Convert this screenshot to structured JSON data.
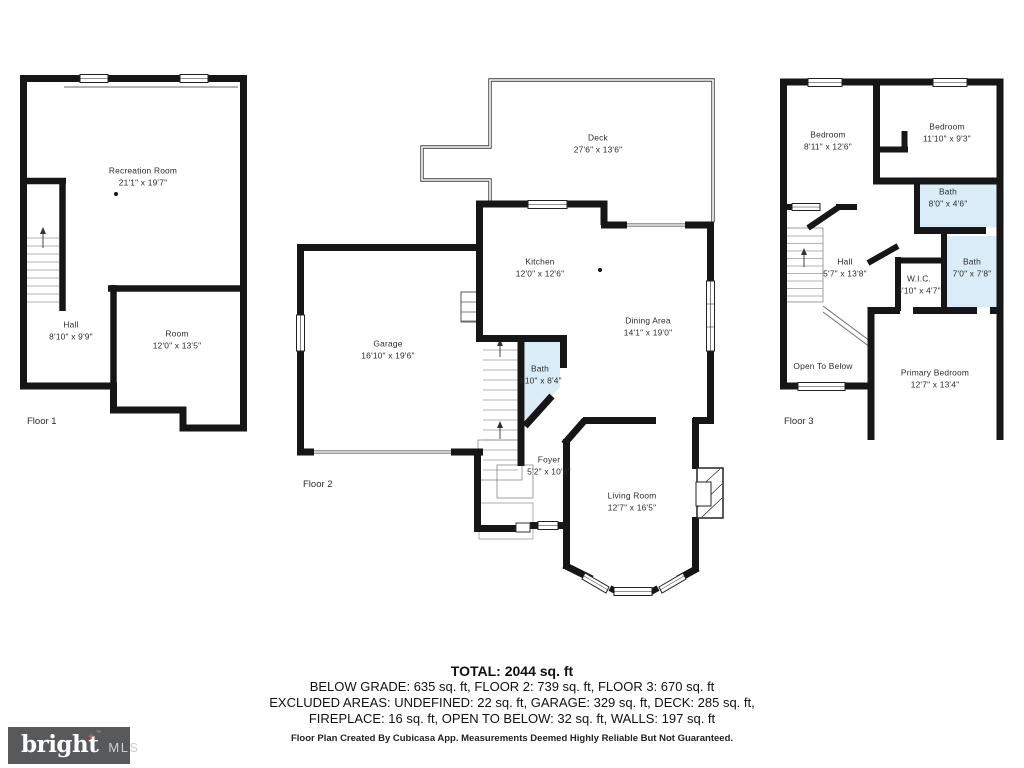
{
  "floors": [
    {
      "label": "Floor 1",
      "rooms": [
        {
          "name": "Recreation Room",
          "dims": "21'1\" x 19'7\""
        },
        {
          "name": "Hall",
          "dims": "8'10\" x 9'9\""
        },
        {
          "name": "Room",
          "dims": "12'0\" x 13'5\""
        }
      ]
    },
    {
      "label": "Floor 2",
      "rooms": [
        {
          "name": "Deck",
          "dims": "27'6\" x 13'6\""
        },
        {
          "name": "Kitchen",
          "dims": "12'0\" x 12'6\""
        },
        {
          "name": "Dining Area",
          "dims": "14'1\" x 19'0\""
        },
        {
          "name": "Garage",
          "dims": "16'10\" x 19'6\""
        },
        {
          "name": "Bath",
          "dims": "3'10\" x 8'4\""
        },
        {
          "name": "Foyer",
          "dims": "5'2\" x 10'8\""
        },
        {
          "name": "Living Room",
          "dims": "12'7\" x 16'5\""
        }
      ]
    },
    {
      "label": "Floor 3",
      "rooms": [
        {
          "name": "Bedroom",
          "dims": "8'11\" x 12'6\""
        },
        {
          "name": "Bedroom",
          "dims": "11'10\" x 9'3\""
        },
        {
          "name": "Bath",
          "dims": "8'0\" x 4'6\""
        },
        {
          "name": "Hall",
          "dims": "5'7\" x 13'8\""
        },
        {
          "name": "W.I.C.",
          "dims": "3'10\" x 4'7\""
        },
        {
          "name": "Bath",
          "dims": "7'0\" x 7'8\""
        },
        {
          "name": "Open To Below",
          "dims": ""
        },
        {
          "name": "Primary Bedroom",
          "dims": "12'7\" x 13'4\""
        }
      ]
    }
  ],
  "summary": {
    "total": "TOTAL: 2044 sq. ft",
    "line2": "BELOW GRADE: 635 sq. ft, FLOOR 2: 739 sq. ft, FLOOR 3: 670 sq. ft",
    "line3": "EXCLUDED AREAS: UNDEFINED: 22 sq. ft, GARAGE: 329 sq. ft, DECK: 285 sq. ft,",
    "line4": "FIREPLACE: 16 sq. ft, OPEN TO BELOW: 32 sq. ft, WALLS: 197 sq. ft",
    "disclaimer": "Floor Plan Created By Cubicasa App. Measurements Deemed Highly Reliable But Not Guaranteed."
  },
  "logo": {
    "brand": "bright",
    "plus": "+",
    "tm": "™",
    "suffix": "MLS"
  },
  "colors": {
    "wall": "#161616",
    "bath_fill": "#d9ecf7",
    "logo_bg": "#58595b",
    "logo_accent": "#e4572e"
  }
}
